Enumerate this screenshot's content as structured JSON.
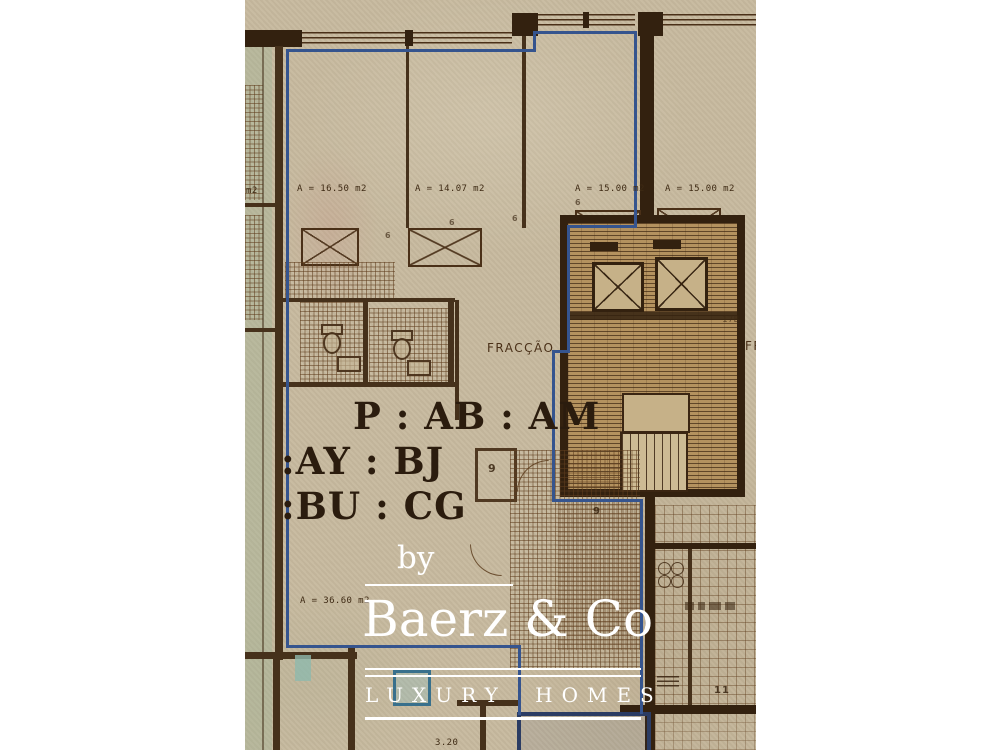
{
  "plan": {
    "area_labels": {
      "left_partial": "m2",
      "room1": "A = 16.50 m2",
      "room2": "A = 14.07 m2",
      "room3": "A = 15.00 m2",
      "room4": "A = 15.00 m2",
      "living": "A = 36.60 m2"
    },
    "fraccao_label": "FRACÇÃO",
    "fraccao_label_right": "FR",
    "stamp_lines": {
      "l1": "P : AB : AM",
      "l2": ":AY : BJ",
      "l3": ":BU : CG"
    },
    "core_label": "17B",
    "room_numbers": {
      "hall": "9",
      "kitchen": "9",
      "balcony": "11"
    },
    "window_markers": {
      "w1": "6",
      "w2": "6",
      "w3": "6",
      "w4": "6"
    },
    "dimension_bottom": "3.20"
  },
  "watermark": {
    "prefix": "by",
    "brand": "Baerz & Co",
    "tagline": "LUXURY HOMES"
  },
  "colors": {
    "paper": "#c7ba9f",
    "wall_brown": "#46311b",
    "wall_dark": "#33210f",
    "unit_outline_blue": "#35548e",
    "navy_outline": "#2b3c63",
    "watermark_white": "#ffffff"
  }
}
